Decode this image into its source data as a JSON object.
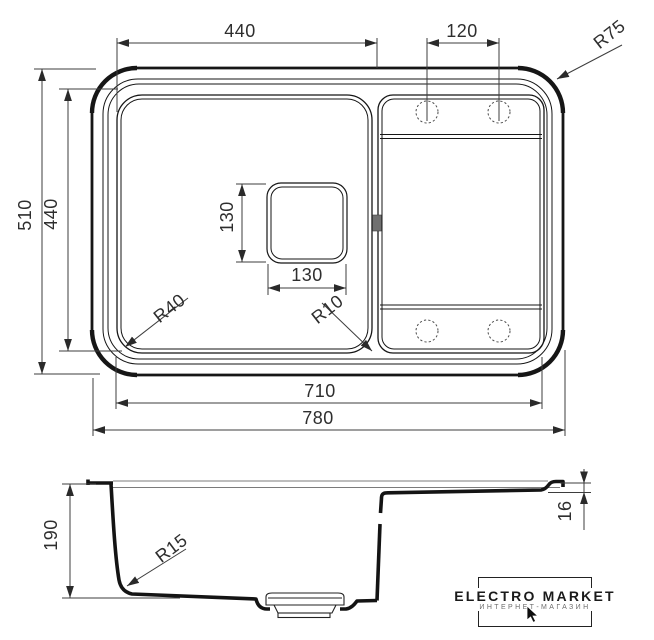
{
  "drawing": {
    "top_view": {
      "dim_bowl_width_top": "440",
      "dim_hole_spacing": "120",
      "dim_outer_corner_radius": "R75",
      "dim_overall_depth": "510",
      "dim_bowl_depth": "440",
      "dim_drain_square_height": "130",
      "dim_drain_square_width": "130",
      "dim_bowl_corner_radius": "R40",
      "dim_drain_corner_radius": "R10",
      "dim_inner_length": "710",
      "dim_overall_length": "780"
    },
    "section_view": {
      "dim_bowl_depth": "190",
      "dim_bottom_corner_radius": "R15",
      "dim_drainer_ledge_depth": "16"
    }
  },
  "logo": {
    "brand": "ELECTRO MARKET",
    "tagline": "ИНТЕРНЕТ-МАГАЗИН"
  },
  "colors": {
    "line": "#161616",
    "dim_line": "#3d3d3d",
    "text": "#2e2e2e"
  }
}
